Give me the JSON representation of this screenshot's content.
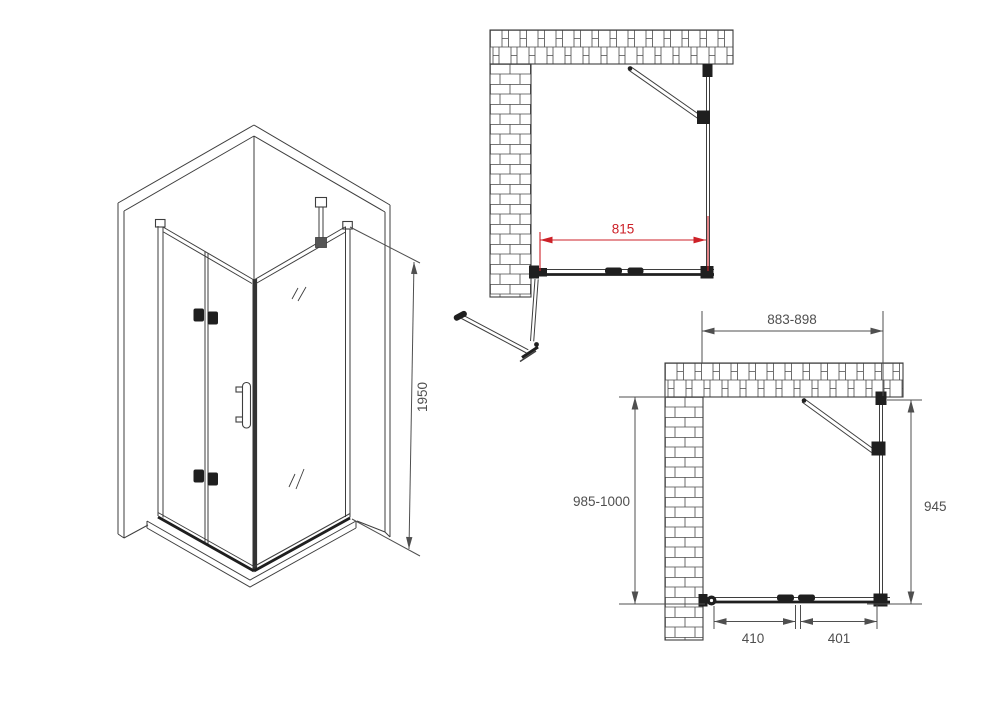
{
  "colors": {
    "background": "#ffffff",
    "line": "#3e3e3e",
    "dark_fitting": "#1f1f1f",
    "dimension_text": "#4f4f4f",
    "accent_red": "#cd2128"
  },
  "isometric": {
    "dim_height": "1950"
  },
  "plan_open": {
    "dim_opening_width": "815"
  },
  "plan_closed": {
    "dim_total_width": "883-898",
    "dim_total_depth": "985-1000",
    "dim_side_panel": "945",
    "dim_door_left": "410",
    "dim_door_right": "401"
  }
}
